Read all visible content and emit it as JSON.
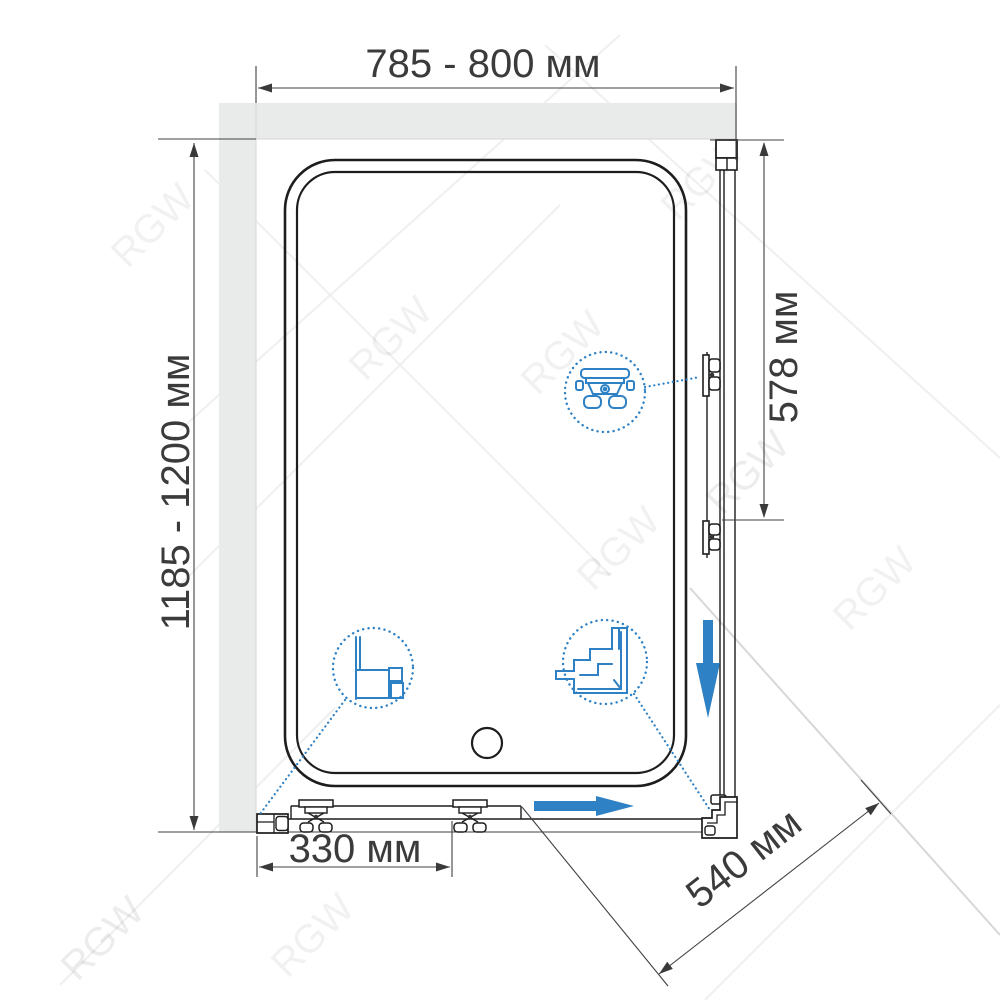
{
  "title": "Shower enclosure plan-view dimension diagram",
  "watermark": {
    "text": "RGW"
  },
  "dimensions": {
    "top_width": {
      "label": "785 - 800 мм"
    },
    "left_height": {
      "label": "1185 - 1200 мм"
    },
    "right_panel": {
      "label": "578 мм"
    },
    "door_bottom": {
      "label": "330 мм"
    },
    "side_panel_width": {
      "label": "540 мм"
    }
  },
  "arrows": {
    "door_slide_direction": "right",
    "side_panel_slide_direction": "down"
  },
  "details": [
    {
      "name": "roller-carriage-detail",
      "description": "sliding door roller carriage"
    },
    {
      "name": "wall-profile-detail",
      "description": "wall mounting profile cross-section"
    },
    {
      "name": "corner-connector-detail",
      "description": "corner profile connector"
    }
  ],
  "colors": {
    "accent_blue": "#2e81c4",
    "drawing_line": "#1d1d1d",
    "wall_fill": "#e9eaea",
    "dimension_text": "#3b3b3b"
  }
}
